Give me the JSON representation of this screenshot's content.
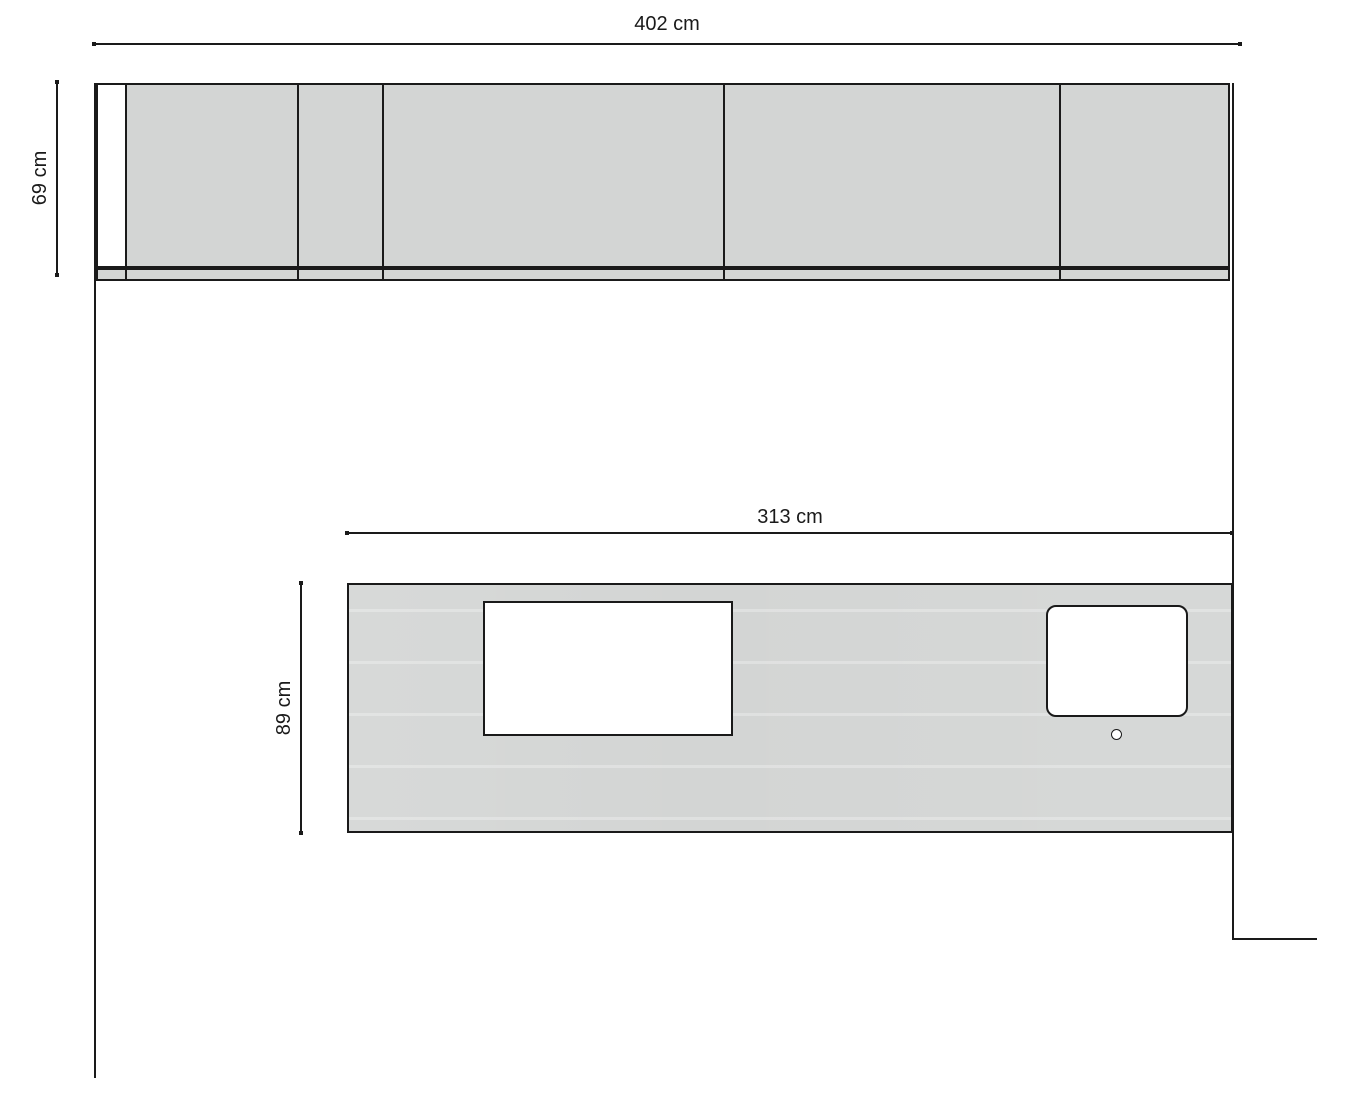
{
  "drawing": {
    "type": "kitchen-plan",
    "dimensions": {
      "total_width": {
        "label": "402 cm"
      },
      "cabinet_height": {
        "label": "69 cm"
      },
      "countertop_width": {
        "label": "313 cm"
      },
      "countertop_depth": {
        "label": "89 cm"
      }
    }
  },
  "colors": {
    "fill": "#d3d5d4",
    "line": "#1a1a1a",
    "background": "#ffffff"
  }
}
